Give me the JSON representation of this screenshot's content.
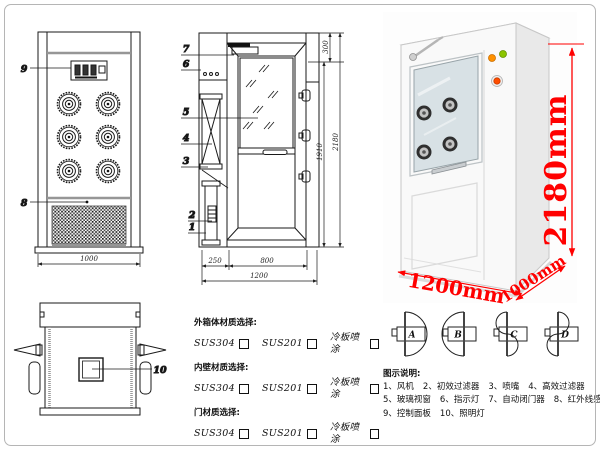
{
  "page": {
    "background": "#ffffff",
    "border_color": "#b5b5b5"
  },
  "drawing": {
    "callouts": {
      "c1": "1",
      "c2": "2",
      "c3": "3",
      "c4": "4",
      "c5": "5",
      "c6": "6",
      "c7": "7",
      "c8": "8",
      "c9": "9",
      "c10": "10"
    },
    "dimensions": {
      "front_width": "1000",
      "depth_filter": "250",
      "depth_door": "800",
      "depth_total": "1200",
      "height_top": "300",
      "height_door": "1910",
      "height_total": "2180"
    }
  },
  "photo": {
    "height_label": "2180mm",
    "width_label": "1200mm",
    "depth_label": "1000mm",
    "dim_color": "#ff0000",
    "indicator_colors": {
      "power_light": "#ff9100",
      "run_light": "#8bc400",
      "emergency_button": "#ff4d00"
    }
  },
  "materials": {
    "sections": [
      {
        "title": "外箱体材质选择:",
        "options": [
          "SUS304",
          "SUS201",
          "冷板喷涂"
        ]
      },
      {
        "title": "内壁材质选择:",
        "options": [
          "SUS304",
          "SUS201",
          "冷板喷涂"
        ]
      },
      {
        "title": "门材质选择:",
        "options": [
          "SUS304",
          "SUS201",
          "冷板喷涂"
        ]
      }
    ]
  },
  "legend": {
    "doors": [
      "A",
      "B",
      "C",
      "D"
    ],
    "title": "图示说明:",
    "items": [
      "1、风机",
      "2、初效过滤器",
      "3、喷嘴",
      "4、高效过滤器",
      "5、玻璃视窗",
      "6、指示灯",
      "7、自动闭门器",
      "8、红外线感应器",
      "9、控制面板",
      "10、照明灯"
    ]
  }
}
